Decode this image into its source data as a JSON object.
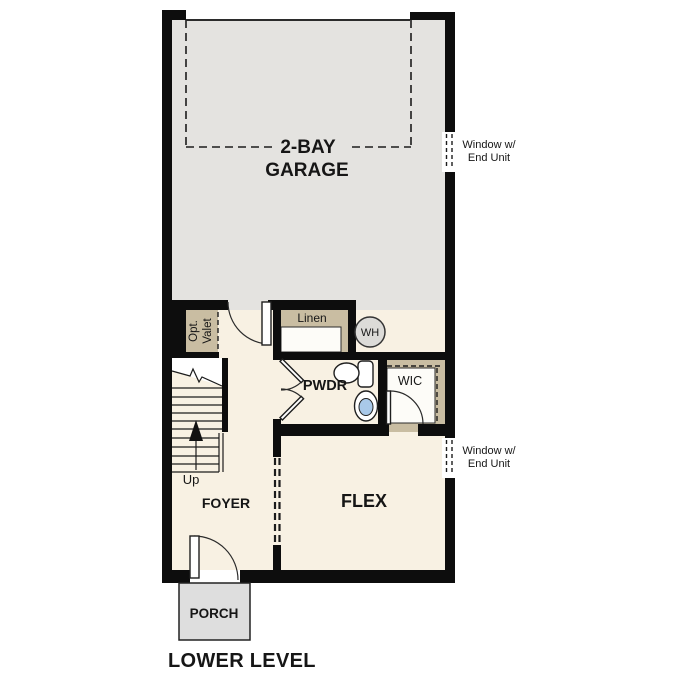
{
  "title": "LOWER LEVEL",
  "colors": {
    "wall": "#0d0d0d",
    "garage_floor": "#e4e3e0",
    "room_floor": "#f8f1e3",
    "closet": "#c9bda2",
    "porch": "#dedede",
    "water_heater": "#dcdbd8",
    "sink_basin": "#a9c9e9"
  },
  "rooms": {
    "garage": {
      "label_line1": "2-BAY",
      "label_line2": "GARAGE"
    },
    "foyer": {
      "label": "FOYER"
    },
    "flex": {
      "label": "FLEX"
    },
    "powder": {
      "label": "PWDR"
    },
    "wic": {
      "label": "WIC"
    },
    "linen": {
      "label": "Linen"
    },
    "valet": {
      "label_line1": "Opt.",
      "label_line2": "Valet"
    },
    "porch": {
      "label": "PORCH"
    },
    "water_heater": {
      "label": "WH"
    }
  },
  "stairs": {
    "direction_label": "Up"
  },
  "windows": [
    {
      "line1": "Window w/",
      "line2": "End Unit"
    },
    {
      "line1": "Window w/",
      "line2": "End Unit"
    }
  ]
}
